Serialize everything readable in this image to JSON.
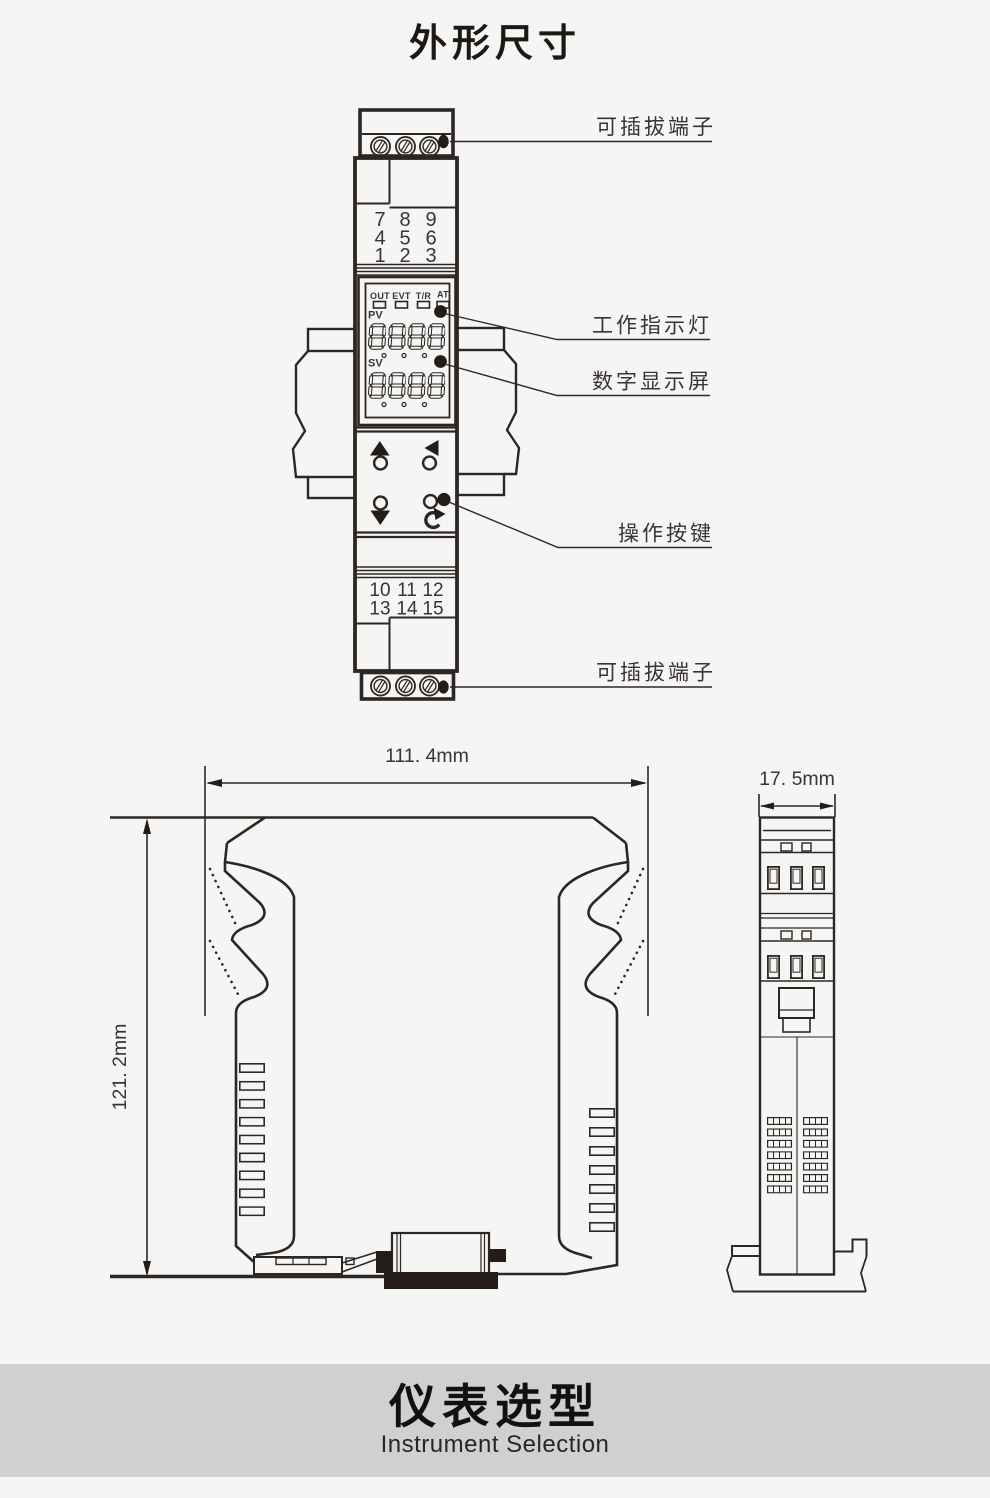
{
  "page": {
    "title": "外形尺寸"
  },
  "colors": {
    "background": "#f5f5f4",
    "line": "#2e2624",
    "text": "#3b3335",
    "red_accent": "#e8383a",
    "footer_band": "#d1d0d0"
  },
  "front_view": {
    "labels": {
      "terminal_top": "可插拔端子",
      "indicator": "工作指示灯",
      "display": "数字显示屏",
      "buttons": "操作按键",
      "terminal_bottom": "可插拔端子"
    },
    "status_leds": [
      "OUT",
      "EVT",
      "T/R",
      "AT"
    ],
    "display": {
      "pv_label": "PV",
      "sv_label": "SV",
      "pv_value": "8888",
      "sv_value": "8888"
    },
    "top_terminal_rows": [
      [
        {
          "v": "7",
          "color": "#e8383a"
        },
        {
          "v": "8",
          "color": "#e8383a"
        },
        {
          "v": "9"
        }
      ],
      [
        {
          "v": "4"
        },
        {
          "v": "5"
        },
        {
          "v": "6"
        }
      ],
      [
        {
          "v": "1"
        },
        {
          "v": "2"
        },
        {
          "v": "3"
        }
      ]
    ],
    "bottom_terminal_rows": [
      [
        {
          "v": "10"
        },
        {
          "v": "11"
        },
        {
          "v": "12"
        }
      ],
      [
        {
          "v": "13"
        },
        {
          "v": "14"
        },
        {
          "v": "15"
        }
      ]
    ]
  },
  "dimensions": {
    "width_label": "111. 4mm",
    "height_label": "121. 2mm",
    "depth_label": "17. 5mm"
  },
  "footer": {
    "title": "仪表选型",
    "subtitle": "Instrument Selection"
  }
}
